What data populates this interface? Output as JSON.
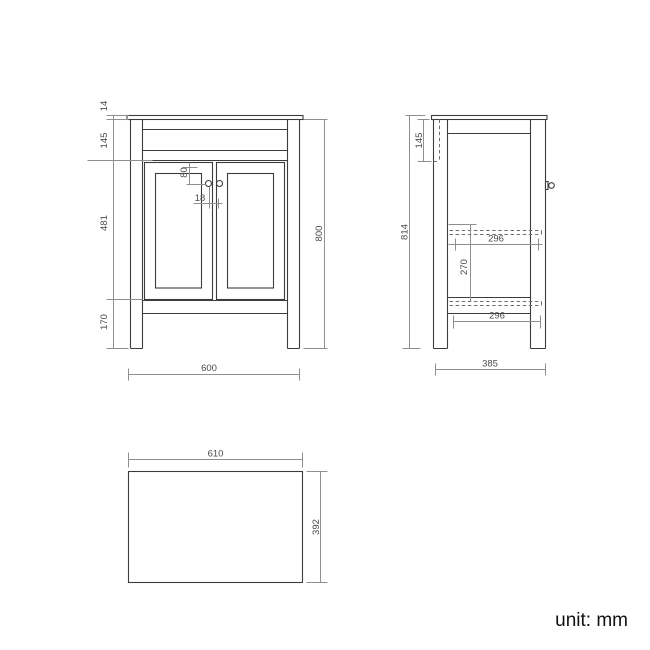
{
  "unit_label": "unit: mm",
  "colors": {
    "background": "#ffffff",
    "object_line": "#3c3c3c",
    "dimension_line": "#8f8f8f",
    "hidden_line": "#6f6f6f",
    "dimension_text": "#4a4a4a",
    "unit_text": "#101010"
  },
  "front": {
    "d14": "14",
    "d145": "145",
    "d80": "80",
    "d18": "18",
    "d481": "481",
    "d170": "170",
    "d800": "800",
    "d600": "600"
  },
  "side": {
    "d145": "145",
    "d814": "814",
    "d296_top": "296",
    "d270": "270",
    "d296_bottom": "296",
    "d385": "385"
  },
  "top": {
    "d610": "610",
    "d392": "392"
  }
}
